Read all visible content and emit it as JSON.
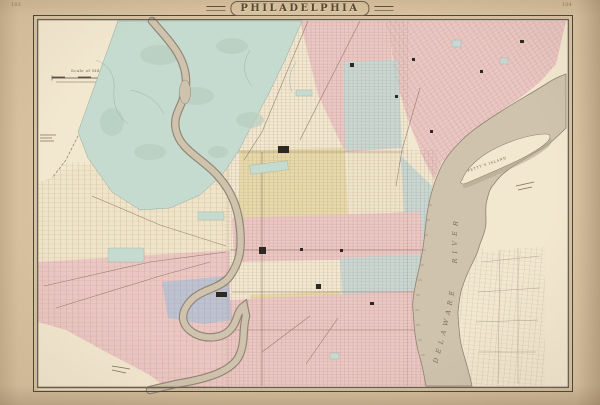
{
  "page": {
    "title": "PHILADELPHIA",
    "plate_left": "103",
    "plate_right": "104"
  },
  "map": {
    "labels": {
      "delaware_river": "DELAWARE RIVER",
      "pettys_island": "PETTY'S ISLAND",
      "scale_caption": "Scale of Miles"
    },
    "features": [
      "Fairmount Park",
      "Schuylkill River",
      "Delaware River",
      "Petty's Island",
      "Center City street grid",
      "Kensington diagonal grid",
      "West Philadelphia grid",
      "South Philadelphia grid",
      "Camden New Jersey grid"
    ],
    "colors": {
      "paper": "#d8c2a0",
      "plate": "#f2e7cf",
      "park": "#c6dbcf",
      "river": "#cfc3ad",
      "river_edge": "#8d8270",
      "ward_pink": "#ecc6c3",
      "ward_yellow": "#e7d9a8",
      "ward_blue": "#c9d7d3",
      "ward_lavender": "#bdc2d2",
      "ward_cream": "#efe4c8",
      "street": "#a08878",
      "ink": "#564a3c"
    }
  }
}
